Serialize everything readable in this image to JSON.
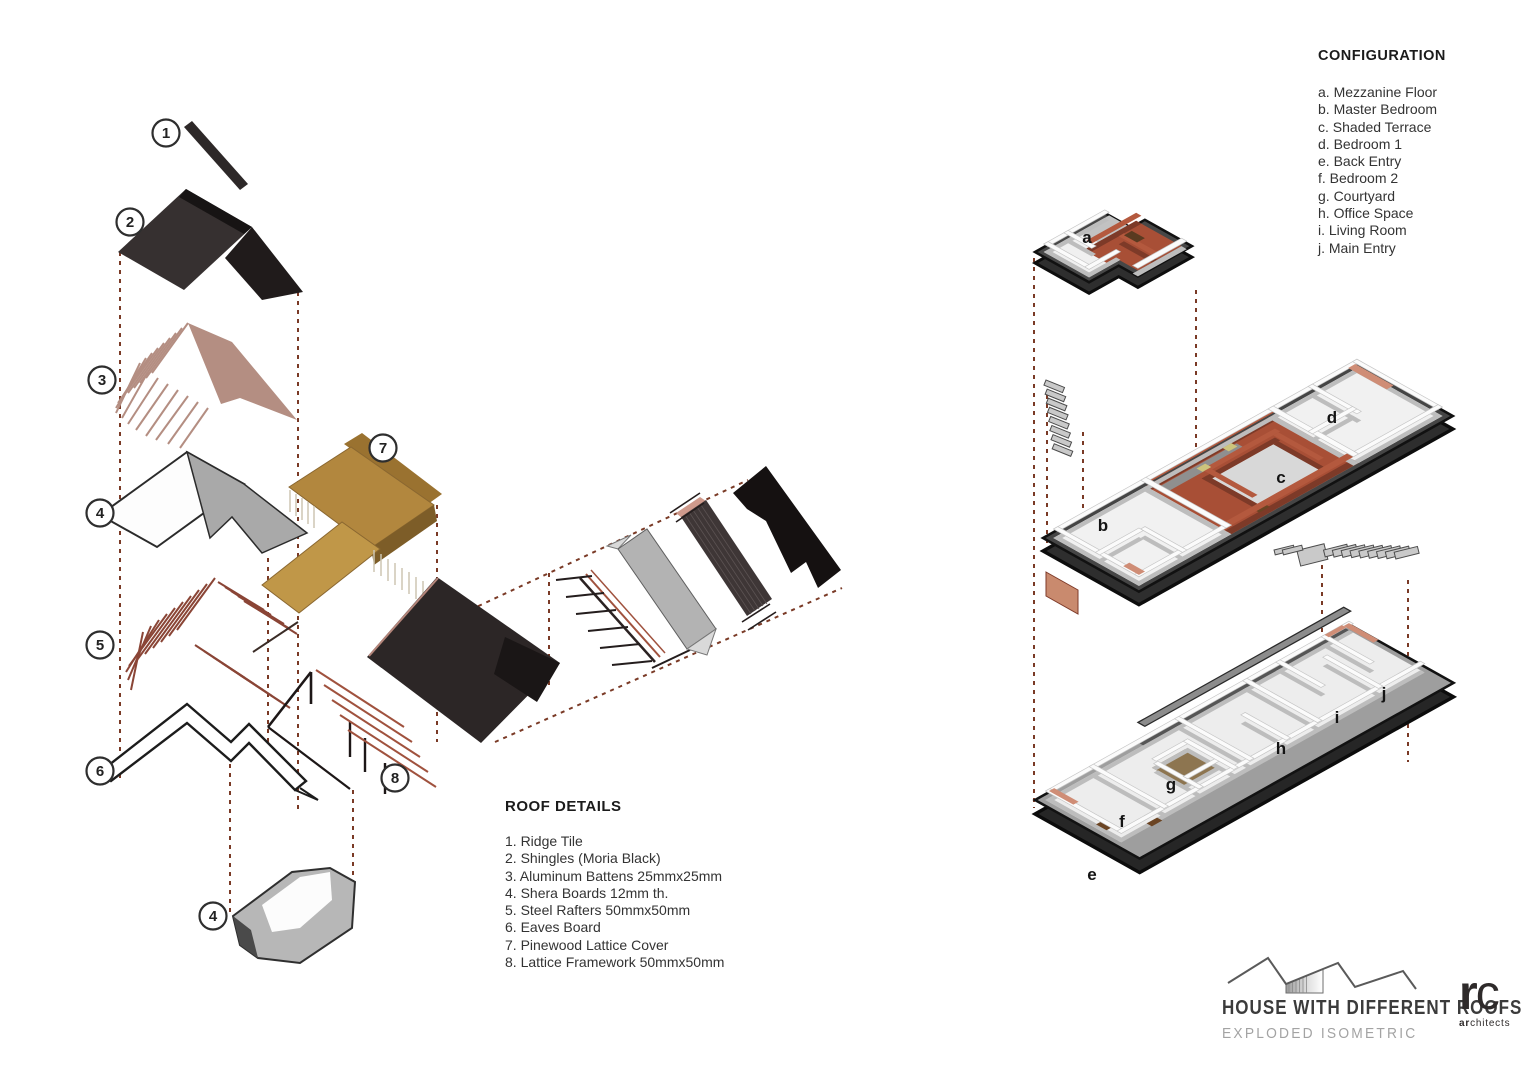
{
  "configuration": {
    "title": "CONFIGURATION",
    "items": [
      "a. Mezzanine Floor",
      "b. Master Bedroom",
      "c. Shaded Terrace",
      "d. Bedroom 1",
      "e. Back Entry",
      "f. Bedroom 2",
      "g. Courtyard",
      "h. Office Space",
      "i. Living Room",
      "j. Main Entry"
    ]
  },
  "roof_details": {
    "title": "ROOF DETAILS",
    "items": [
      "1. Ridge Tile",
      "2. Shingles (Moria Black)",
      "3. Aluminum Battens 25mmx25mm",
      "4. Shera Boards 12mm th.",
      "5. Steel Rafters 50mmx50mm",
      "6. Eaves Board",
      "7. Pinewood Lattice Cover",
      "8. Lattice Framework 50mmx50mm"
    ]
  },
  "callouts": [
    "1",
    "2",
    "3",
    "4",
    "5",
    "6",
    "7",
    "8",
    "4"
  ],
  "room_letters": [
    "a",
    "b",
    "c",
    "d",
    "e",
    "f",
    "g",
    "h",
    "i",
    "j"
  ],
  "titleblock": {
    "project": "HOUSE WITH DIFFERENT ROOFS",
    "drawing": "EXPLODED ISOMETRIC"
  },
  "firm": {
    "initial_r": "r",
    "initial_c": "c",
    "name_bold": "ar",
    "name_rest": "chitects"
  },
  "colors": {
    "shingle_black": "#2c2626",
    "batten_salmon": "#b48e82",
    "rafter_red": "#8a4536",
    "pinewood_tan": "#b2873e",
    "terracotta": "#a84f36",
    "terracotta_dark": "#7d3a28",
    "slab_dark": "#2e2e2e",
    "slab_gray": "#9e9e9e",
    "dashed_brown": "#7a3a26",
    "courtyard_tan": "#8d7550"
  }
}
